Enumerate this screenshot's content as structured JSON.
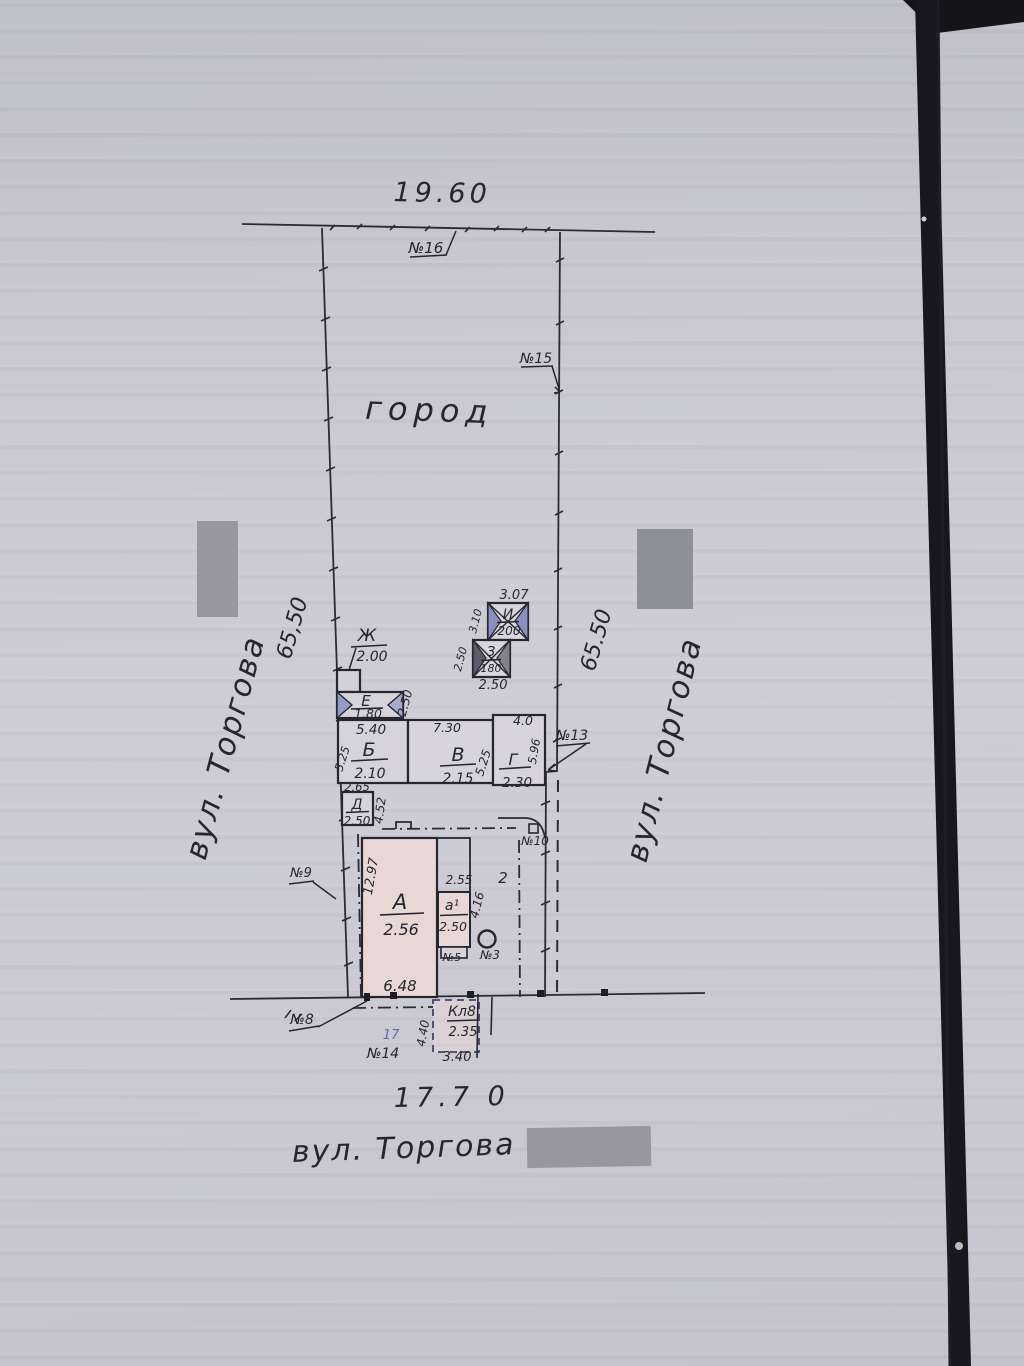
{
  "plan": {
    "top_dimension": "19.60",
    "bottom_dimension": "17.7 0",
    "garden": "город",
    "left_side": {
      "street": "вул. Торгова",
      "length": "65,50"
    },
    "right_side": {
      "street": "вул. Торгова",
      "length": "65.50"
    },
    "bottom_street": "вул. Торгова",
    "markers": {
      "m16": "№16",
      "m15": "№15",
      "m13": "№13",
      "m10": "№10",
      "m9": "№9",
      "m8": "№8",
      "m14": "№14",
      "m14_blue": "17",
      "m3": "№3",
      "m5": "№5",
      "section": "2"
    },
    "buildings": {
      "a_main": {
        "letter": "А",
        "value": "2.56",
        "dim_side": "12.97",
        "dim_front": "6.48"
      },
      "a1": {
        "letter": "а¹",
        "value": "2.50",
        "dim_top": "2.55",
        "dim_side": "4.16"
      },
      "b": {
        "letter": "Б",
        "value": "2.10",
        "dim_top": "5.40",
        "dim_side": "5.25"
      },
      "v": {
        "letter": "В",
        "value": "2.15",
        "dim_top": "7.30",
        "dim_side": "5.25"
      },
      "g": {
        "letter": "Г",
        "value": "2.30",
        "dim_top": "4.0",
        "dim_side": "5.96"
      },
      "d": {
        "letter": "Д",
        "value": "2.50",
        "dim_top": "2.65",
        "dim_side": "4.52"
      },
      "e": {
        "letter": "Е",
        "value": "1.80",
        "dim_side": "2.50"
      },
      "zh": {
        "letter": "Ж",
        "value": "2.00"
      },
      "z": {
        "letter": "З",
        "value": "180",
        "dim_side": "2.50",
        "dim_bottom": "2.50"
      },
      "i": {
        "letter": "И",
        "value": "200",
        "dim_top": "3.07",
        "dim_side": "3.10"
      },
      "kl": {
        "letter": "Кл8",
        "value": "2.35",
        "dim_side": "4.40",
        "dim_bottom": "3.40"
      }
    }
  }
}
